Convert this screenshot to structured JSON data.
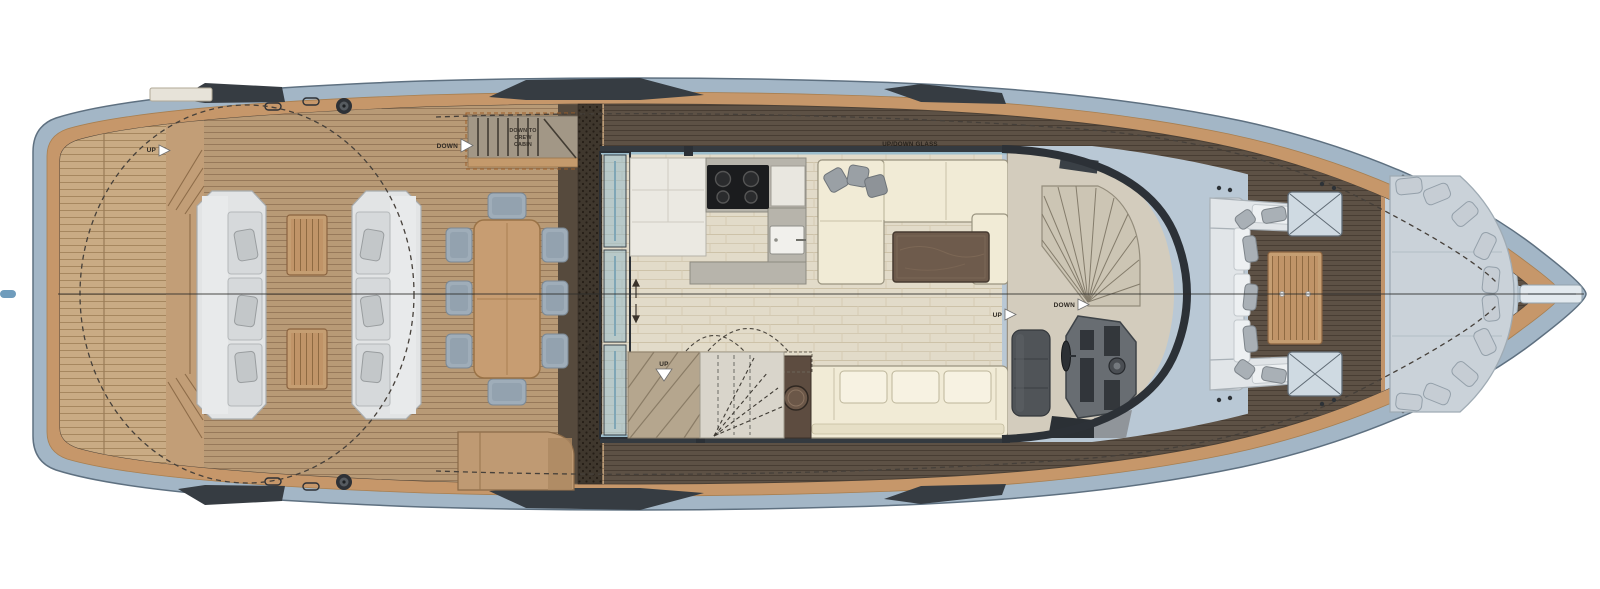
{
  "labels": {
    "transom_steps_up": "UP",
    "crew_stairs_pointer": "DOWN",
    "crew_stairs_line1": "DOWN TO",
    "crew_stairs_line2": "CREW",
    "crew_stairs_line3": "CABIN",
    "salon_stairs_up": "UP",
    "helm_up": "UP",
    "helm_stairs_down": "DOWN",
    "glass_note": "UP/DOWN GLASS"
  },
  "icons": {
    "cleat-icon": "small oval mooring cleat with two bolt dots",
    "winch-icon": "concentric circle capstan winch",
    "hatch-icon": "rounded square deck hatch with X cross",
    "pointer-icon": "white triangle direction arrow",
    "steering-wheel-icon": "vertical ellipse helm wheel",
    "cooktop-icon": "black hob with four burners",
    "sink-icon": "white square basin with faucet"
  },
  "palette": {
    "hull_side": "#a3b6c6",
    "caprail_wood": "#c6976a",
    "walkway_teak": "#5d5145",
    "swim_teak": "#c9ab84",
    "aft_deck_teak": "#b89a76",
    "interior_floor": "#e2dbc9",
    "galley_counter": "#b7b4ab",
    "cream_upholstery": "#f1ebd6",
    "gray_cushion": "#d6d9db",
    "sun_pad": "#cad2d9",
    "bow_deck": "#b9c8d5",
    "marble_dark": "#5d4c40",
    "frame_dark": "#343a40",
    "glass_blue": "#9cbecd"
  }
}
